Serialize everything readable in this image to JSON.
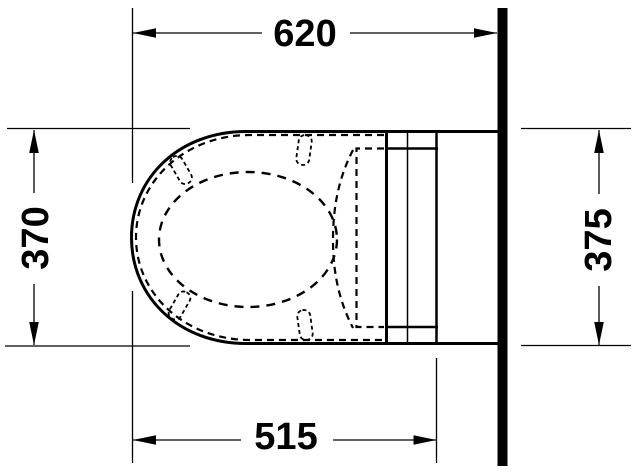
{
  "drawing": {
    "background": "#ffffff",
    "line_color": "#000000",
    "dimensions": {
      "top": "620",
      "left": "370",
      "right": "375",
      "bottom": "515"
    }
  }
}
